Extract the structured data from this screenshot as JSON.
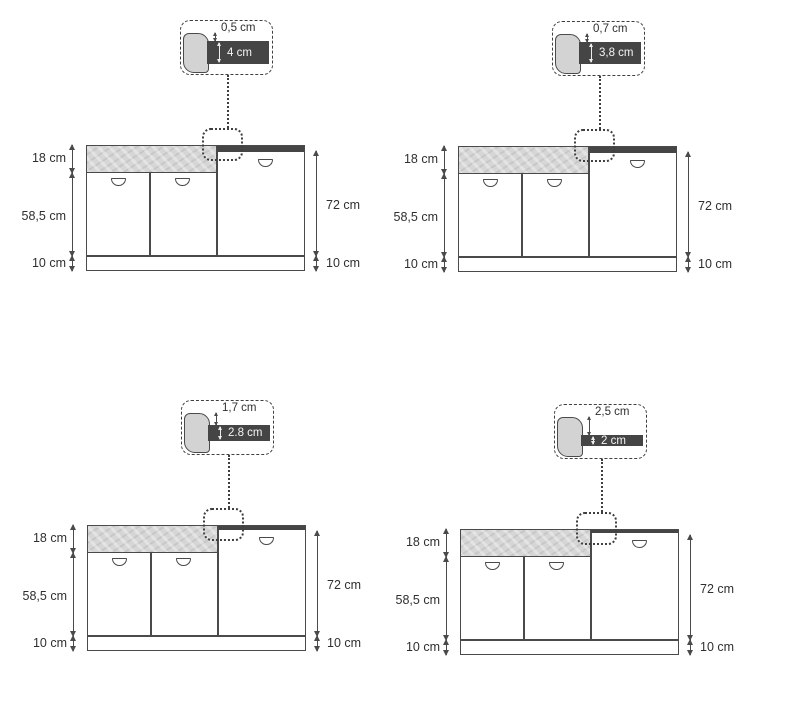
{
  "diagram": {
    "description_names": {
      "callout": "countertop-edge-detail",
      "cabinet": "kitchen-base-cabinet-elevation"
    }
  },
  "panels": [
    {
      "id": "top-left",
      "callout": {
        "gap_label": "0,5 cm",
        "gap_cm": 0.5,
        "thickness_label": "4 cm",
        "thickness_cm": 4
      },
      "dimensions": {
        "band_height": "18 cm",
        "doors_height": "58,5 cm",
        "plinth_left": "10 cm",
        "total_right": "72 cm",
        "plinth_right": "10 cm"
      }
    },
    {
      "id": "top-right",
      "callout": {
        "gap_label": "0,7 cm",
        "gap_cm": 0.7,
        "thickness_label": "3,8 cm",
        "thickness_cm": 3.8
      },
      "dimensions": {
        "band_height": "18 cm",
        "doors_height": "58,5 cm",
        "plinth_left": "10 cm",
        "total_right": "72 cm",
        "plinth_right": "10 cm"
      }
    },
    {
      "id": "bottom-left",
      "callout": {
        "gap_label": "1,7 cm",
        "gap_cm": 1.7,
        "thickness_label": "2.8 cm",
        "thickness_cm": 2.8
      },
      "dimensions": {
        "band_height": "18 cm",
        "doors_height": "58,5 cm",
        "plinth_left": "10 cm",
        "total_right": "72 cm",
        "plinth_right": "10 cm"
      }
    },
    {
      "id": "bottom-right",
      "callout": {
        "gap_label": "2,5 cm",
        "gap_cm": 2.5,
        "thickness_label": "2 cm",
        "thickness_cm": 2
      },
      "dimensions": {
        "band_height": "18 cm",
        "doors_height": "58,5 cm",
        "plinth_left": "10 cm",
        "total_right": "72 cm",
        "plinth_right": "10 cm"
      }
    }
  ],
  "colors": {
    "outline": "#4a4a4a",
    "band_fill": "#d6d6d6",
    "countertop_dark": "#454545",
    "text": "#2f2f2f",
    "background": "#ffffff"
  }
}
